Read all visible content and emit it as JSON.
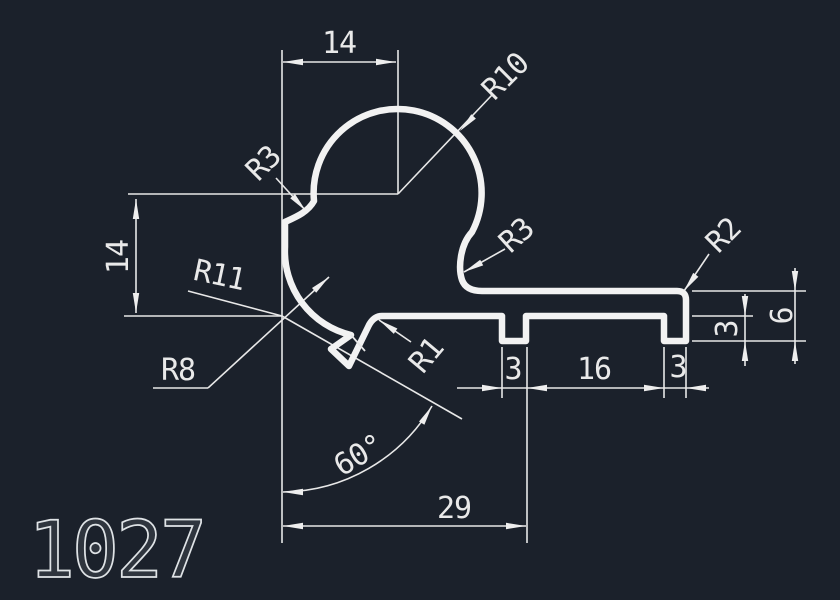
{
  "drawing": {
    "part_number": "1027",
    "colors": {
      "background": "#1b212b",
      "profile_line": "#f2f2f2",
      "dimension_line": "#e8e8e8",
      "text": "#e9e9e9"
    },
    "dimensions": {
      "top_width": "14",
      "left_height": "14",
      "slot1_width": "3",
      "slot_spacing": "16",
      "slot2_width": "3",
      "tab_height": "3",
      "right_height": "6",
      "angle": "60°",
      "base_width": "29"
    },
    "radius_labels": {
      "r3_left": "R3",
      "r10": "R10",
      "r3_right": "R3",
      "r2": "R2",
      "r11": "R11",
      "r8": "R8",
      "r1": "R1"
    }
  }
}
